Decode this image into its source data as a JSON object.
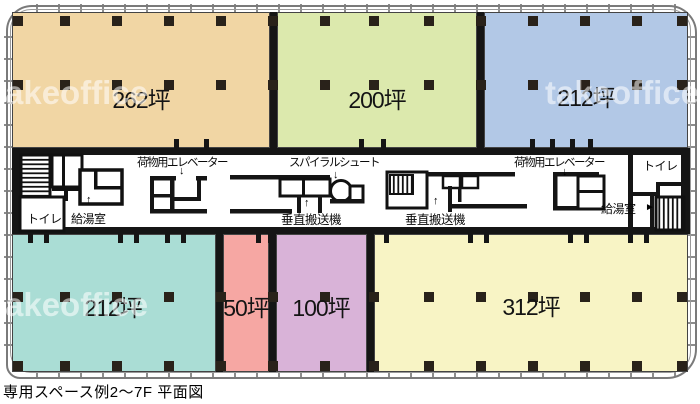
{
  "caption": "専用スペース例2〜7F 平面図",
  "watermark": {
    "text": "takeoffice"
  },
  "zones": [
    {
      "name": "zone-top-left",
      "area_label": "262坪",
      "color": "#f1d6a4"
    },
    {
      "name": "zone-top-center",
      "area_label": "200坪",
      "color": "#dce9ad"
    },
    {
      "name": "zone-top-right",
      "area_label": "212坪",
      "color": "#b2c8e6"
    },
    {
      "name": "zone-bottom-left",
      "area_label": "212坪",
      "color": "#aaddd5"
    },
    {
      "name": "zone-bottom-center-left",
      "area_label": "50坪",
      "color": "#f6a7a3"
    },
    {
      "name": "zone-bottom-center",
      "area_label": "100坪",
      "color": "#d9b3d8"
    },
    {
      "name": "zone-bottom-right",
      "area_label": "312坪",
      "color": "#f8f4c5"
    }
  ],
  "facilities": {
    "freight_elevator_left": "荷物用エレベーター",
    "freight_elevator_right": "荷物用エレベーター",
    "spiral_chute": "スパイラルシュート",
    "vertical_conveyor_left": "垂直搬送機",
    "vertical_conveyor_right": "垂直搬送機",
    "toilet_left": "トイレ",
    "toilet_right": "トイレ",
    "kitchenette_left": "給湯室",
    "kitchenette_right": "給湯室"
  },
  "icons": {
    "arrow_down": "↓",
    "arrow_up": "↑",
    "arrow_right": "►"
  },
  "structure": {
    "wall_color": "#151515",
    "columns": {
      "size": 10,
      "color": "#29221a",
      "xs": [
        18,
        65,
        117,
        169,
        221,
        273,
        325,
        374,
        429,
        481,
        533,
        585,
        637,
        682
      ],
      "row_ys": [
        21,
        85,
        297,
        366
      ]
    }
  }
}
